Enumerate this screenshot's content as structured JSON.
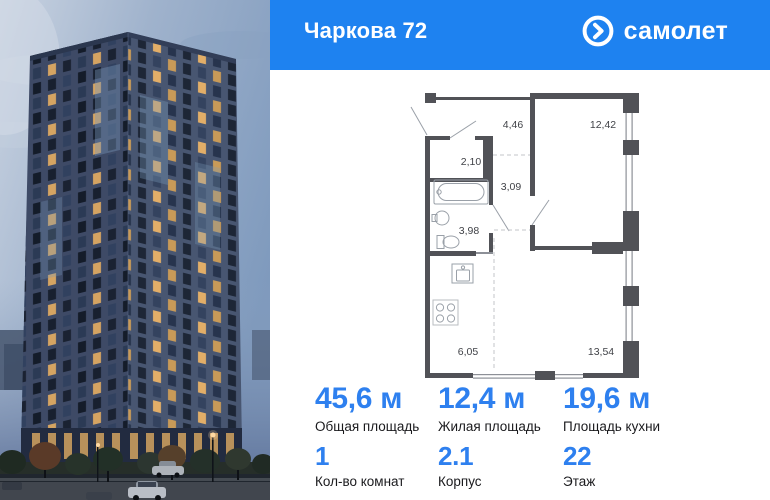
{
  "header": {
    "title": "Чаркова 72",
    "brand_name": "самолет",
    "brand_icon": "arrow-circle-icon",
    "bg_color": "#1e82f0"
  },
  "floor_plan": {
    "room_areas": [
      "4,46",
      "12,42",
      "2,10",
      "3,09",
      "3,98",
      "6,05",
      "13,54"
    ],
    "wall_color": "#515257"
  },
  "stats": [
    {
      "value": "45,6 м",
      "label": "Общая площадь"
    },
    {
      "value": "12,4 м",
      "label": "Жилая площадь"
    },
    {
      "value": "19,6 м",
      "label": "Площадь кухни"
    }
  ],
  "details": [
    {
      "value": "1",
      "label": "Кол-во комнат"
    },
    {
      "value": "2.1",
      "label": "Корпус"
    },
    {
      "value": "22",
      "label": "Этаж"
    }
  ],
  "colors": {
    "accent_blue": "#2e80ef",
    "header_blue": "#1e82f0"
  }
}
